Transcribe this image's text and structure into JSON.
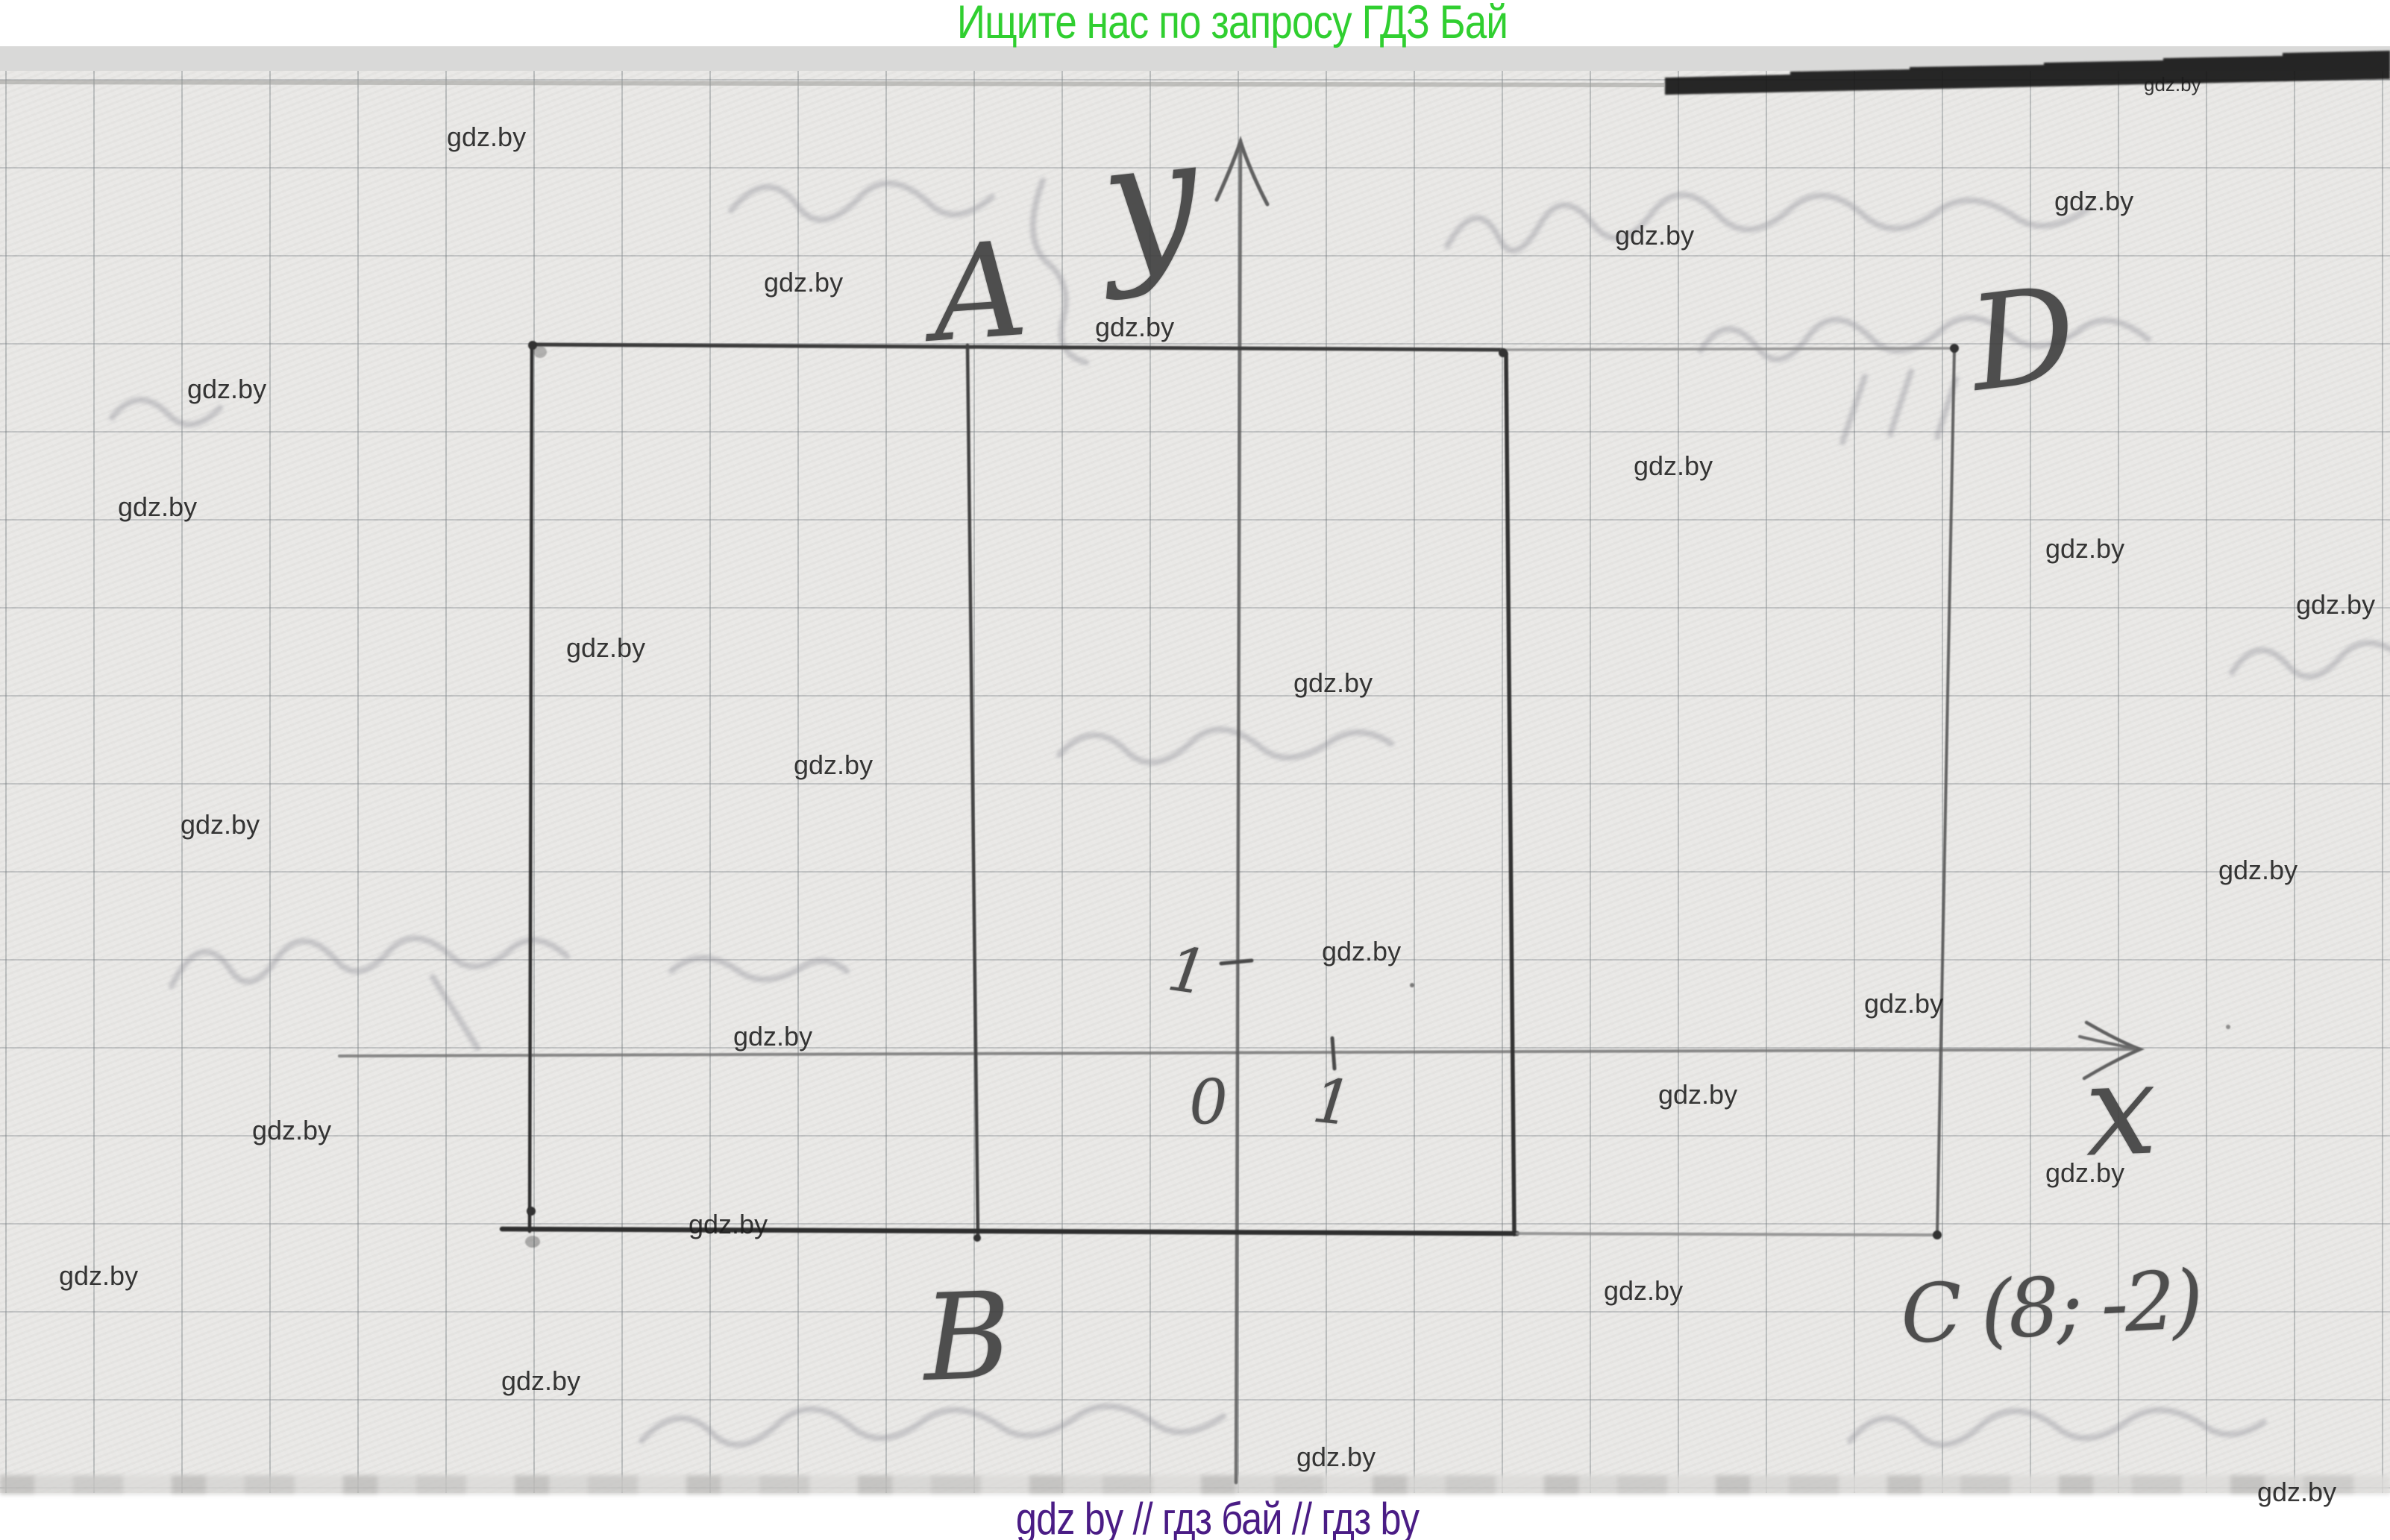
{
  "texts": {
    "title": "Ищите нас по запросу ГДЗ Бай",
    "footer": "gdz by  //  гдз бай  //  гдз by"
  },
  "colors": {
    "title_green": "#30cf30",
    "footer_purple": "#4a1c85",
    "pencil": "#3d3d3d",
    "watermark": "#1c1c1c"
  },
  "watermark": {
    "label": "gdz.by",
    "positions": [
      [
        599,
        166,
        36
      ],
      [
        1024,
        361,
        36
      ],
      [
        1468,
        421,
        36
      ],
      [
        2165,
        298,
        36
      ],
      [
        2754,
        252,
        36
      ],
      [
        2874,
        100,
        26
      ],
      [
        251,
        504,
        36
      ],
      [
        158,
        662,
        36
      ],
      [
        2190,
        607,
        36
      ],
      [
        2742,
        718,
        36
      ],
      [
        3078,
        793,
        36
      ],
      [
        759,
        851,
        36
      ],
      [
        1734,
        898,
        36
      ],
      [
        1064,
        1008,
        36
      ],
      [
        242,
        1088,
        36
      ],
      [
        2974,
        1149,
        36
      ],
      [
        1772,
        1258,
        36
      ],
      [
        2499,
        1328,
        36
      ],
      [
        983,
        1372,
        36
      ],
      [
        2223,
        1450,
        36
      ],
      [
        338,
        1498,
        36
      ],
      [
        2742,
        1555,
        36
      ],
      [
        923,
        1624,
        36
      ],
      [
        79,
        1693,
        36
      ],
      [
        2150,
        1713,
        36
      ],
      [
        672,
        1834,
        36
      ],
      [
        1738,
        1936,
        36
      ],
      [
        3026,
        1983,
        36
      ]
    ]
  },
  "diagram": {
    "point_a": "A",
    "point_b": "B",
    "point_c": "C (8; -2)",
    "point_d": "D",
    "axis_x": "x",
    "axis_y": "y",
    "origin": "0",
    "x_unit": "1",
    "y_unit": "1"
  }
}
